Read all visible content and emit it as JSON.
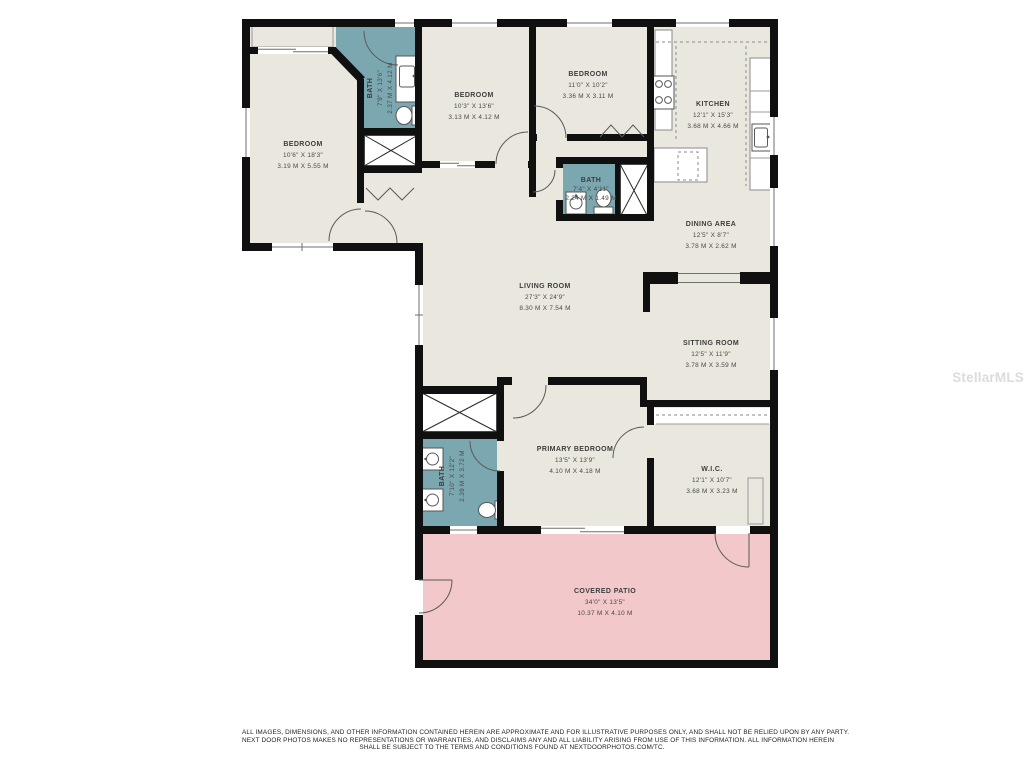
{
  "floorplan": {
    "rooms": [
      {
        "name": "BEDROOM",
        "dim_ft": "10'6\" X 18'3\"",
        "dim_m": "3.19 M X 5.55 M"
      },
      {
        "name": "BATH",
        "dim_ft": "7'9\" X 13'6\"",
        "dim_m": "2.37 M X 4.12 M"
      },
      {
        "name": "BEDROOM",
        "dim_ft": "10'3\" X 13'6\"",
        "dim_m": "3.13 M X 4.12 M"
      },
      {
        "name": "BEDROOM",
        "dim_ft": "11'0\" X 10'2\"",
        "dim_m": "3.36 M X 3.11 M"
      },
      {
        "name": "KITCHEN",
        "dim_ft": "12'1\" X 15'3\"",
        "dim_m": "3.68 M X 4.66 M"
      },
      {
        "name": "BATH",
        "dim_ft": "7'4\" X 4'11\"",
        "dim_m": "2.24 M X 1.49 M"
      },
      {
        "name": "DINING AREA",
        "dim_ft": "12'5\" X 8'7\"",
        "dim_m": "3.78 M X 2.62 M"
      },
      {
        "name": "LIVING ROOM",
        "dim_ft": "27'3\" X 24'9\"",
        "dim_m": "8.30 M X 7.54 M"
      },
      {
        "name": "SITTING ROOM",
        "dim_ft": "12'5\" X 11'9\"",
        "dim_m": "3.78 M X 3.59 M"
      },
      {
        "name": "PRIMARY BEDROOM",
        "dim_ft": "13'5\" X 13'9\"",
        "dim_m": "4.10 M X 4.18 M"
      },
      {
        "name": "BATH",
        "dim_ft": "7'10\" X 12'2\"",
        "dim_m": "2.39 M X 3.72 M"
      },
      {
        "name": "W.I.C.",
        "dim_ft": "12'1\" X 10'7\"",
        "dim_m": "3.68 M X 3.23 M"
      },
      {
        "name": "COVERED PATIO",
        "dim_ft": "34'0\" X 13'5\"",
        "dim_m": "10.37 M X 4.10 M"
      }
    ],
    "colors": {
      "floor": "#eae8de",
      "bath": "#7ba7b1",
      "patio": "#f2c8cb",
      "wall": "#101010"
    },
    "watermark": "StellarMLS",
    "footer": {
      "line1": "ALL IMAGES, DIMENSIONS, AND OTHER INFORMATION CONTAINED HEREIN ARE APPROXIMATE AND FOR ILLUSTRATIVE PURPOSES ONLY, AND SHALL NOT BE RELIED UPON BY ANY PARTY.",
      "line2": "NEXT DOOR PHOTOS MAKES NO REPRESENTATIONS OR WARRANTIES, AND DISCLAIMS ANY AND ALL LIABILITY ARISING FROM USE OF THIS INFORMATION. ALL INFORMATION HEREIN",
      "line3": "SHALL BE SUBJECT TO THE TERMS AND CONDITIONS FOUND AT NEXTDOORPHOTOS.COM/TC."
    }
  }
}
